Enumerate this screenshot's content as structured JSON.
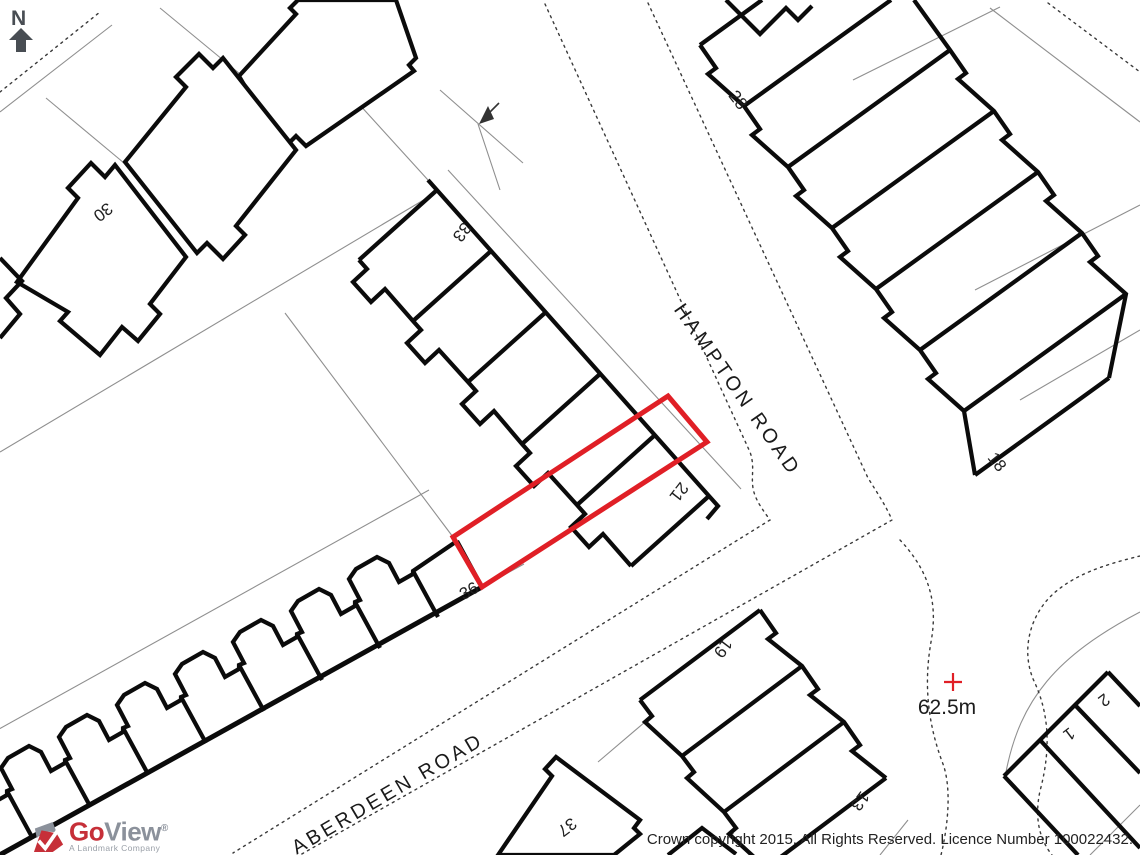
{
  "map": {
    "north_label": "N",
    "road_names": {
      "hampton": "HAMPTON ROAD",
      "aberdeen": "ABERDEEN ROAD"
    },
    "spot_height_label": "62.5m",
    "house_numbers": {
      "n30": "30",
      "n33": "33",
      "n28": "28",
      "n18": "18",
      "n21": "21",
      "n36": "36",
      "n19": "19",
      "n37": "37",
      "n13": "13",
      "n2": "2",
      "n1": "1"
    },
    "colors": {
      "plot_outline": "#e01f26",
      "spot_marker": "#e01f26",
      "building_line": "#0b0b0b",
      "parcel_line": "#8f8f8f"
    }
  },
  "footer": {
    "logo": {
      "go": "Go",
      "view": "View",
      "registered": "®",
      "tagline": "A Landmark Company"
    },
    "copyright": "Crown copyright 2015. All Rights Reserved. Licence Number 100022432."
  }
}
